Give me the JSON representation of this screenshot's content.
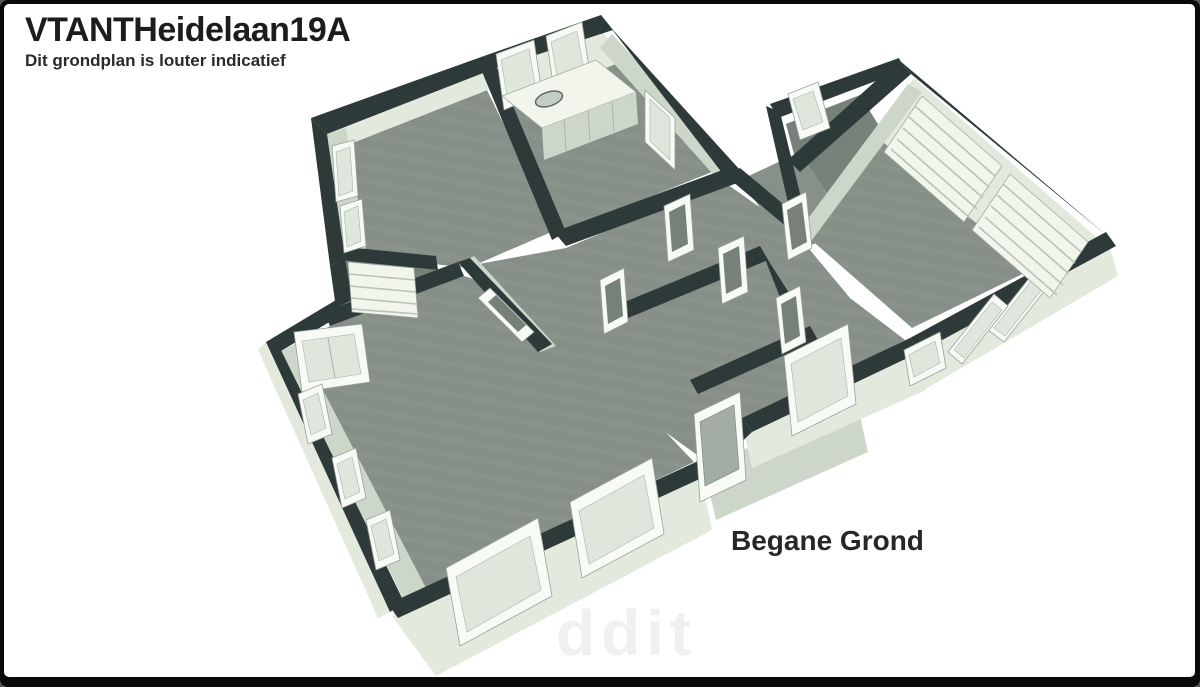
{
  "header": {
    "title": "VTANTHeidelaan19A",
    "subtitle": "Dit grondplan is louter indicatief"
  },
  "plan": {
    "floor_label": "Begane Grond",
    "view": "3d-perspective-floorplan",
    "fixtures": [
      "kitchen-counter-with-sink",
      "kitchen-windows",
      "staircase",
      "garage-doors",
      "living-room-windows",
      "entrance-door",
      "bay-corner-opening",
      "interior-door-frames"
    ]
  },
  "watermark": {
    "text": "ddit"
  },
  "colors": {
    "wall_top": "#2e393a",
    "wall_face_light": "#e3eadd",
    "wall_face_medium": "#ccd6c9",
    "wall_face_dark": "#b6c2b4",
    "floor": "#87918a",
    "floor_dark": "#76817a",
    "window_frame": "#f8faf5",
    "window_pane": "#dfe7dc",
    "fixture_white": "#f1f5ec",
    "canvas_bg": "#ffffff",
    "frame_border": "#0a0a0a",
    "title_text": "#1c1c1e",
    "watermark": "#eef1ed"
  }
}
